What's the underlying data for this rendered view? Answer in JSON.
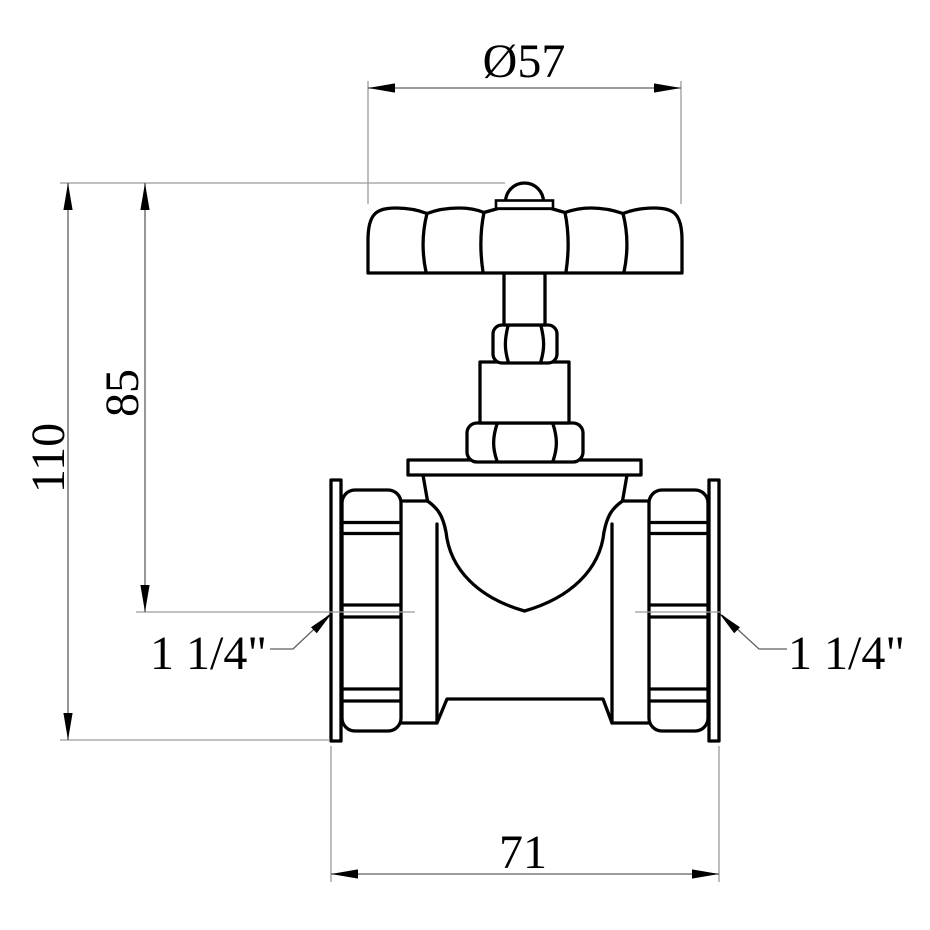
{
  "drawing": {
    "type": "technical-drawing",
    "view": "front elevation",
    "colors": {
      "background": "#ffffff",
      "object_line": "#000000",
      "dimension_line": "#5f5f5f",
      "extension_line": "#9a9a9a",
      "arrow": "#000000",
      "text": "#000000"
    },
    "dimensions": {
      "handwheel_diameter": {
        "label": "Ø57",
        "value": 57,
        "orientation": "horizontal"
      },
      "total_height": {
        "label": "110",
        "value": 110,
        "orientation": "vertical"
      },
      "center_height": {
        "label": "85",
        "value": 85,
        "orientation": "vertical"
      },
      "face_to_face": {
        "label": "71",
        "value": 71,
        "orientation": "horizontal"
      },
      "port_left": {
        "label": "1 1/4\""
      },
      "port_right": {
        "label": "1 1/4\""
      }
    }
  }
}
